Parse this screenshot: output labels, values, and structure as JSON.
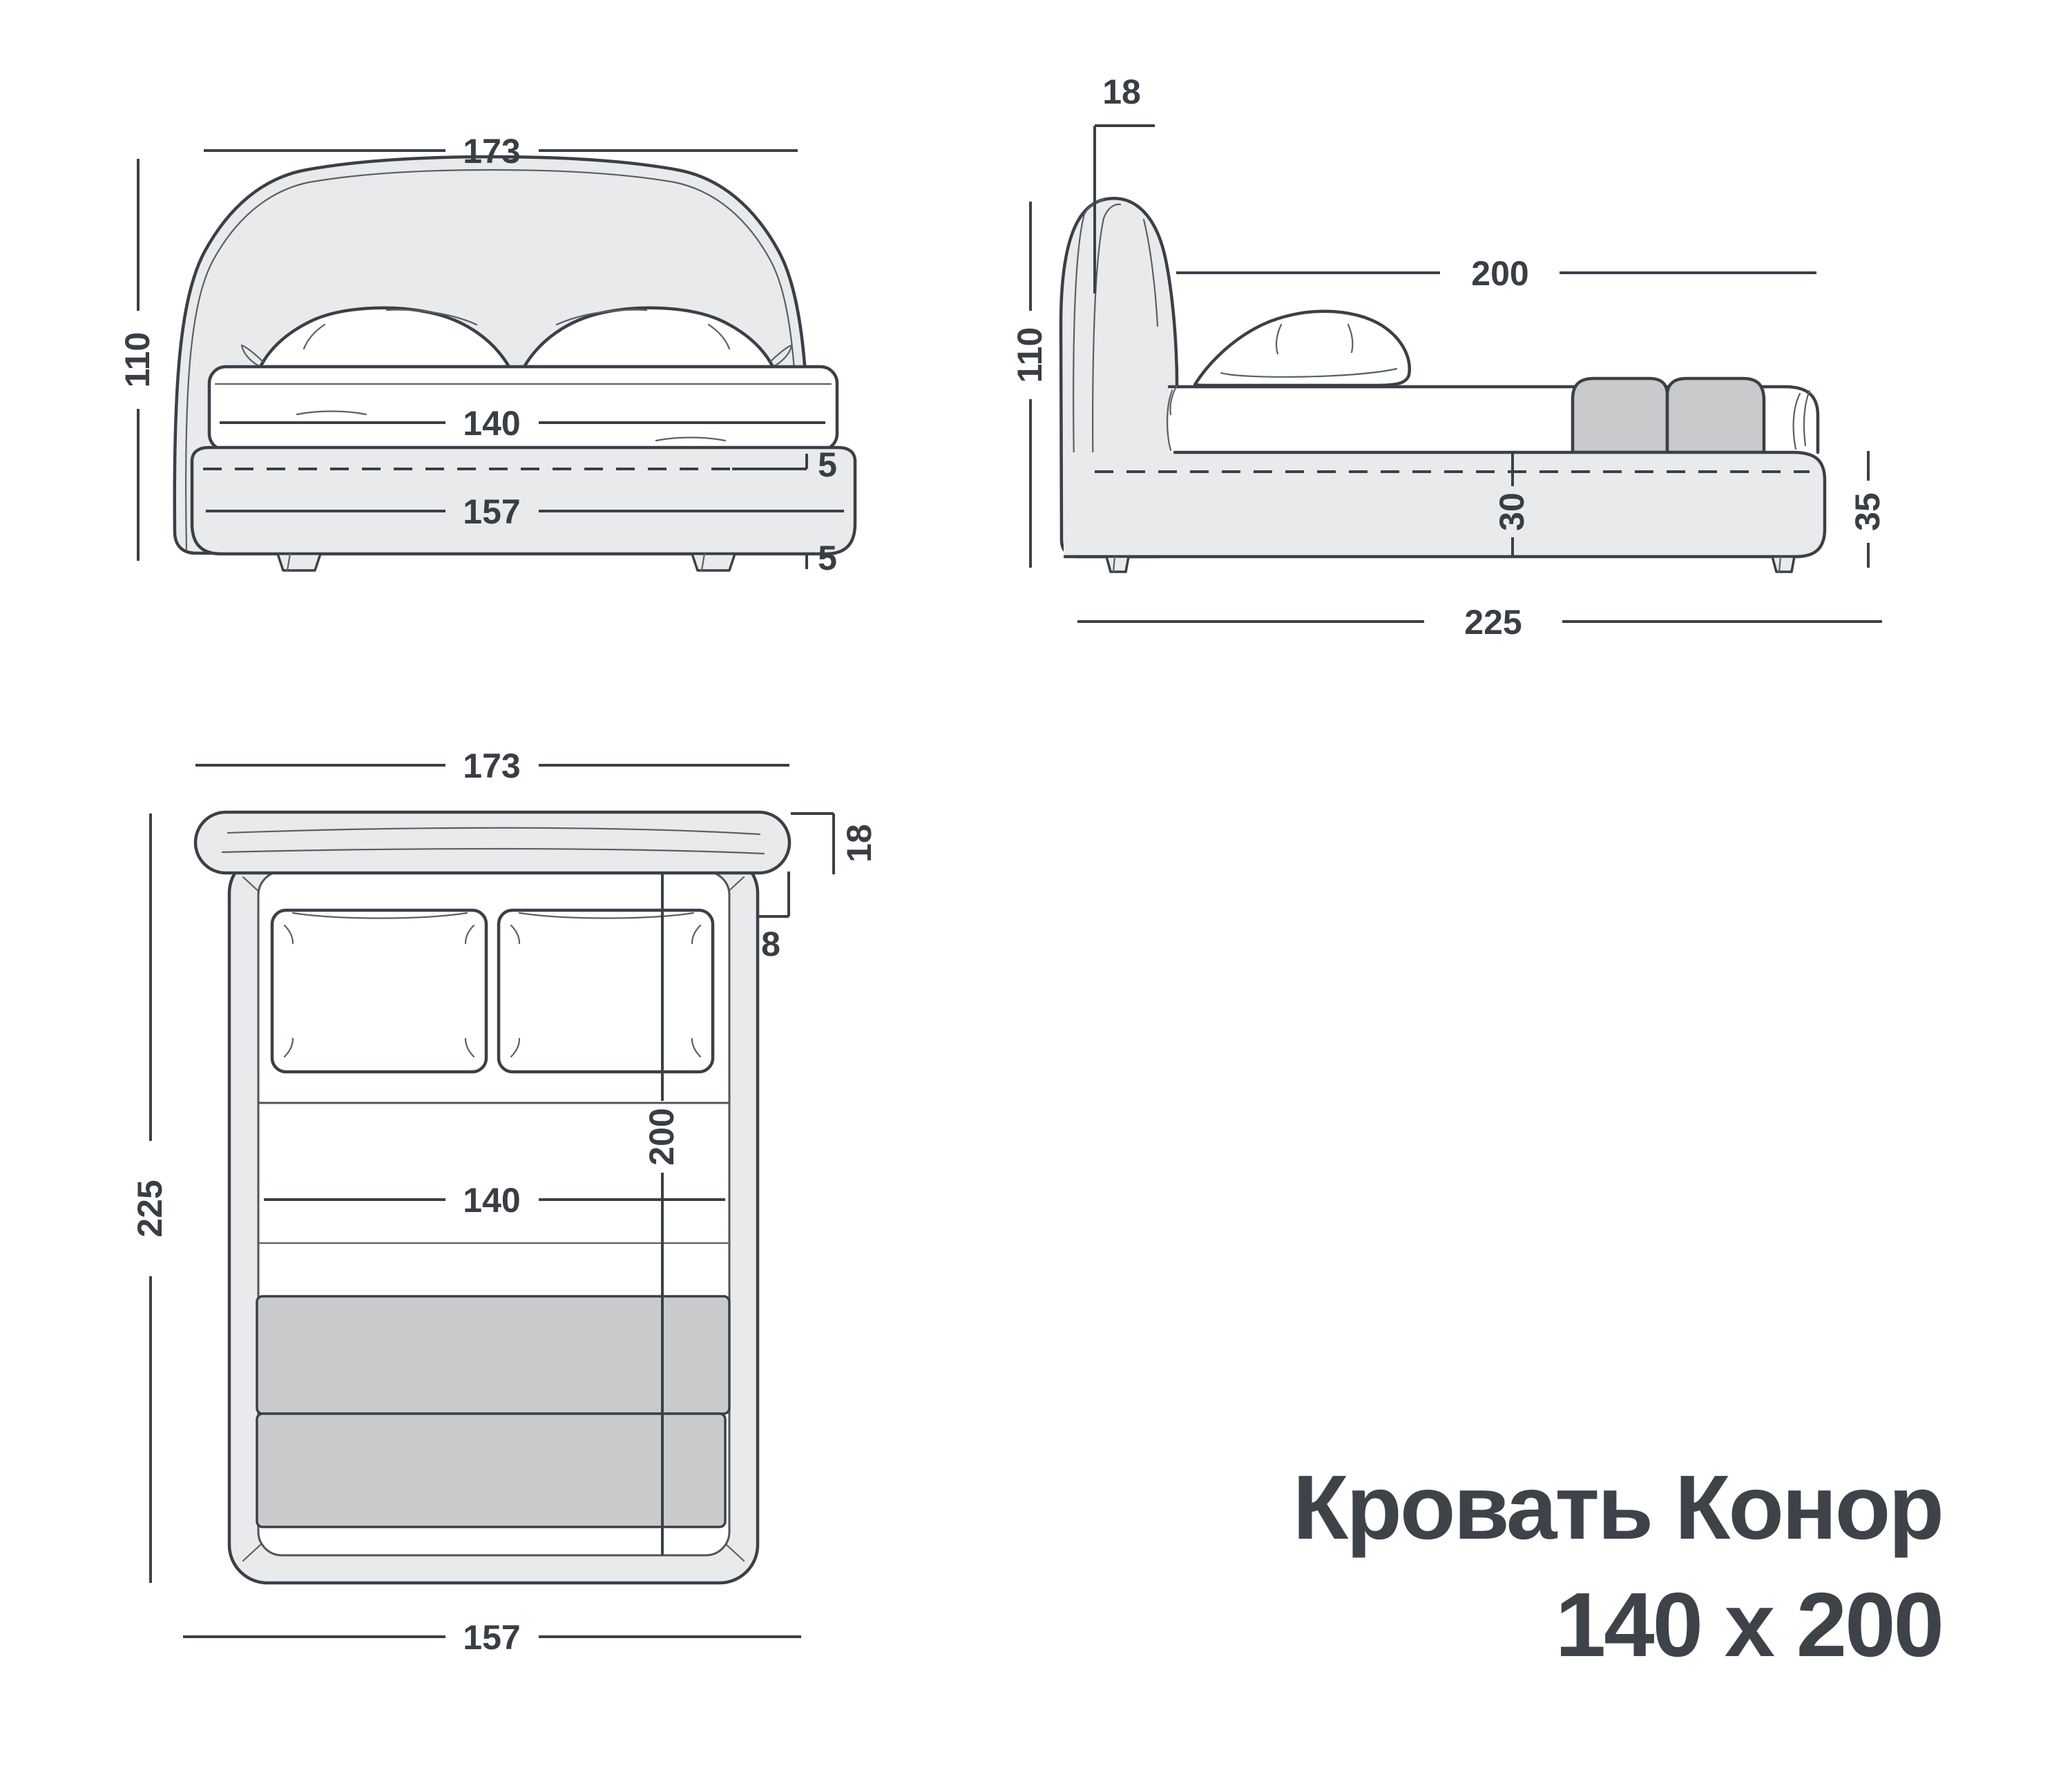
{
  "title": {
    "line1": "Кровать Конор",
    "line2": "140 x 200"
  },
  "colors": {
    "ink": "#3a4046",
    "label": "#383e44",
    "title": "#3d4349",
    "panel": "#e9eaec",
    "blanket": "#c9cacc",
    "surface": "#ffffff",
    "thin": "#5a6065"
  },
  "views": {
    "front": {
      "dims": {
        "width_overall": "173",
        "height": "110",
        "mattress_width": "140",
        "base_width": "157",
        "platform_offset": "5",
        "leg_height": "5"
      }
    },
    "side": {
      "dims": {
        "headboard_depth": "18",
        "height": "110",
        "sleep_length": "200",
        "base_height": "30",
        "base_total_height": "35",
        "length_overall": "225"
      }
    },
    "plan": {
      "dims": {
        "width_overall": "173",
        "headboard_depth": "18",
        "side_overhang": "8",
        "length_overall": "225",
        "sleep_length": "200",
        "mattress_width": "140",
        "base_width": "157"
      }
    }
  }
}
